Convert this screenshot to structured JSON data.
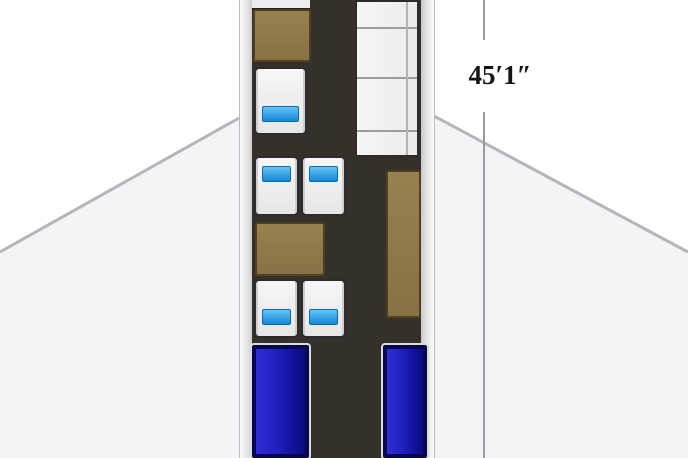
{
  "diagram": {
    "type": "aircraft-cabin-floorplan",
    "dimension_label": "45′1″",
    "colors": {
      "background": "#ffffff",
      "wing_fill": "#f4f4f6",
      "wing_edge": "#b5b5ba",
      "fuselage_wall": "#e3e3e4",
      "cabin_floor": "#36302a",
      "cabinet_wood": "#8e7849",
      "seat_fill": "#f0f0f0",
      "seat_border": "#2c2c2c",
      "seat_cushion_blue": "#1787d6",
      "berth_blue": "#1212a0",
      "berth_border": "#07074e",
      "dimension_line": "#9b9b9f",
      "dimension_text": "#141414"
    },
    "furniture": [
      {
        "name": "forward-stowage",
        "kind": "stowage"
      },
      {
        "name": "forward-cabinet",
        "kind": "cabinet"
      },
      {
        "name": "single-seat-forward",
        "kind": "seat",
        "cushion": "blue"
      },
      {
        "name": "seat-pair-mid",
        "kind": "seat-pair",
        "cushion": "blue"
      },
      {
        "name": "conference-table",
        "kind": "table"
      },
      {
        "name": "seat-pair-aft",
        "kind": "seat-pair",
        "cushion": "blue"
      },
      {
        "name": "berth-left",
        "kind": "berth"
      },
      {
        "name": "side-divan",
        "kind": "divan",
        "cushions": 3
      },
      {
        "name": "aft-cabinet-right",
        "kind": "cabinet"
      },
      {
        "name": "berth-right",
        "kind": "berth"
      }
    ]
  }
}
